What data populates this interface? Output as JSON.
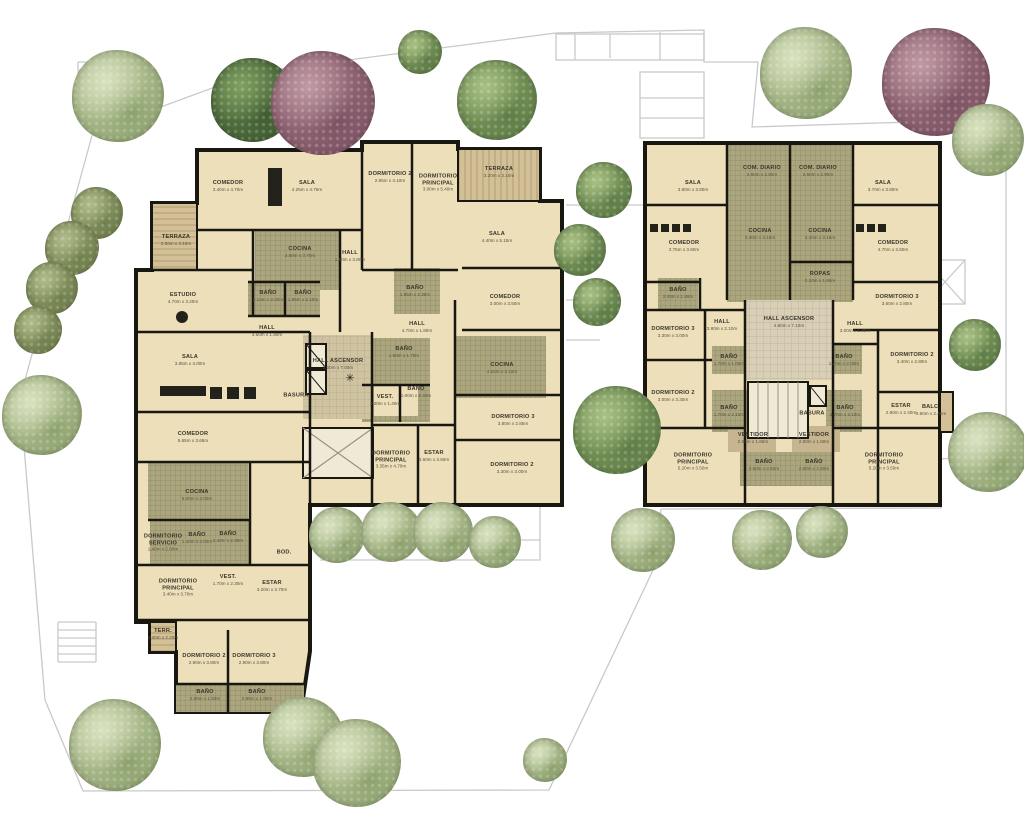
{
  "palette": {
    "floor": "#ecdfba",
    "floor_light": "#efe9d6",
    "tile": "#aba67e",
    "core_tile": "#cfc3a2",
    "wood": "#d3c096",
    "wood_stripe": "#b29c74",
    "wall": "#181810",
    "site_line": "#c9c9c9",
    "furniture": "#23221a",
    "trees": {
      "pale": {
        "hi": "#d9e2c0",
        "md": "#c3cfa6",
        "lo": "#8ba06b"
      },
      "green": {
        "hi": "#a9c084",
        "md": "#86a365",
        "lo": "#5d7c45"
      },
      "dark": {
        "hi": "#7fa062",
        "md": "#5f7f48",
        "lo": "#3f5c31"
      },
      "olive": {
        "hi": "#b0bc89",
        "md": "#93a06b",
        "lo": "#6f7f4c"
      },
      "red": {
        "hi": "#c09aa4",
        "md": "#9f7280",
        "lo": "#7c5262"
      }
    }
  },
  "icons": {
    "compass": "✳"
  },
  "rooms": [
    {
      "name": "COMEDOR",
      "dims": "3.40m x 4.70m",
      "x": 228,
      "y": 186
    },
    {
      "name": "SALA",
      "dims": "4.25m x 4.75m",
      "x": 307,
      "y": 186
    },
    {
      "name": "TERRAZA",
      "dims": "2.50m x 4.10m",
      "x": 176,
      "y": 240
    },
    {
      "name": "COCINA",
      "dims": "3.80m x 3.70m",
      "x": 300,
      "y": 252
    },
    {
      "name": "HALL",
      "dims": "1.50m x 3.80m",
      "x": 350,
      "y": 256
    },
    {
      "name": "ESTUDIO",
      "dims": "4.70m x 3.20m",
      "x": 183,
      "y": 298
    },
    {
      "name": "BAÑO",
      "dims": "2.10m x 2.00m",
      "x": 268,
      "y": 296
    },
    {
      "name": "BAÑO",
      "dims": "1.85m x 2.10m",
      "x": 303,
      "y": 296
    },
    {
      "name": "DORMITORIO 2",
      "dims": "2.85m x 4.10m",
      "x": 390,
      "y": 177
    },
    {
      "name": "DORMITORIO PRINCIPAL",
      "dims": "3.00m x 5.40m",
      "x": 438,
      "y": 183
    },
    {
      "name": "BAÑO",
      "dims": "1.85m x 2.35m",
      "x": 415,
      "y": 291
    },
    {
      "name": "HALL",
      "dims": "4.70m x 1.80m",
      "x": 417,
      "y": 327
    },
    {
      "name": "TERRAZA",
      "dims": "3.20m x 3.10m",
      "x": 499,
      "y": 172
    },
    {
      "name": "SALA",
      "dims": "4.40m x 5.15m",
      "x": 497,
      "y": 237
    },
    {
      "name": "COMEDOR",
      "dims": "3.00m x 3.50m",
      "x": 505,
      "y": 300
    },
    {
      "name": "COCINA",
      "dims": "4.55m x 3.10m",
      "x": 502,
      "y": 368
    },
    {
      "name": "BAÑO",
      "dims": "1.50m x 1.70m",
      "x": 404,
      "y": 352
    },
    {
      "name": "VEST.",
      "dims": "3.30m x 1.40m",
      "x": 385,
      "y": 400
    },
    {
      "name": "BAÑO",
      "dims": "1.00m x 2.40m",
      "x": 416,
      "y": 392
    },
    {
      "name": "DORMITORIO PRINCIPAL",
      "dims": "3.35m x 4.70m",
      "x": 391,
      "y": 460
    },
    {
      "name": "ESTAR",
      "dims": "3.60m x 3.60m",
      "x": 434,
      "y": 456
    },
    {
      "name": "DORMITORIO 3",
      "dims": "3.80m x 2.85m",
      "x": 513,
      "y": 420
    },
    {
      "name": "DORMITORIO 2",
      "dims": "3.30m x 3.00m",
      "x": 512,
      "y": 468
    },
    {
      "name": "HALL ASCENSOR",
      "dims": "3.00m x 7.00m",
      "x": 338,
      "y": 364
    },
    {
      "name": "BASURA",
      "dims": "",
      "x": 296,
      "y": 396
    },
    {
      "name": "SALA",
      "dims": "3.85m x 4.00m",
      "x": 190,
      "y": 360
    },
    {
      "name": "HALL",
      "dims": "3.50m x 1.90m",
      "x": 267,
      "y": 331
    },
    {
      "name": "COMEDOR",
      "dims": "5.65m x 3.65m",
      "x": 193,
      "y": 437
    },
    {
      "name": "COCINA",
      "dims": "5.00m x 3.00m",
      "x": 197,
      "y": 495
    },
    {
      "name": "DORMITORIO SERVICIO",
      "dims": "1.40m x 2.80m",
      "x": 163,
      "y": 543
    },
    {
      "name": "BAÑO",
      "dims": "1.40m x 2.00m",
      "x": 197,
      "y": 538
    },
    {
      "name": "BAÑO",
      "dims": "2.40m x 2.30m",
      "x": 228,
      "y": 537
    },
    {
      "name": "BOD.",
      "dims": "",
      "x": 284,
      "y": 553
    },
    {
      "name": "VEST.",
      "dims": "1.70m x 2.30m",
      "x": 228,
      "y": 580
    },
    {
      "name": "ESTAR",
      "dims": "3.20m x 3.70m",
      "x": 272,
      "y": 586
    },
    {
      "name": "DORMITORIO PRINCIPAL",
      "dims": "3.40m x 3.70m",
      "x": 178,
      "y": 588
    },
    {
      "name": "TERR.",
      "dims": "1.40m x 2.20m",
      "x": 163,
      "y": 634
    },
    {
      "name": "DORMITORIO 2",
      "dims": "2.90m x 3.80m",
      "x": 204,
      "y": 659
    },
    {
      "name": "DORMITORIO 3",
      "dims": "2.90m x 3.80m",
      "x": 254,
      "y": 659
    },
    {
      "name": "BAÑO",
      "dims": "2.85m x 1.50m",
      "x": 205,
      "y": 695
    },
    {
      "name": "BAÑO",
      "dims": "2.85m x 1.50m",
      "x": 257,
      "y": 695
    },
    {
      "name": "SALA",
      "dims": "3.80m x 3.80m",
      "x": 693,
      "y": 186
    },
    {
      "name": "COM. DIARIO",
      "dims": "2.50m x 2.90m",
      "x": 762,
      "y": 171
    },
    {
      "name": "COM. DIARIO",
      "dims": "2.50m x 2.90m",
      "x": 818,
      "y": 171
    },
    {
      "name": "SALA",
      "dims": "3.70m x 3.80m",
      "x": 883,
      "y": 186
    },
    {
      "name": "COCINA",
      "dims": "3.30m x 3.15m",
      "x": 760,
      "y": 234
    },
    {
      "name": "COCINA",
      "dims": "3.30m x 3.15m",
      "x": 820,
      "y": 234
    },
    {
      "name": "COMEDOR",
      "dims": "3.75m x 3.60m",
      "x": 684,
      "y": 246
    },
    {
      "name": "COMEDOR",
      "dims": "4.70m x 3.60m",
      "x": 893,
      "y": 246
    },
    {
      "name": "ROPAS",
      "dims": "2.20m x 1.60m",
      "x": 820,
      "y": 277
    },
    {
      "name": "BAÑO",
      "dims": "2.00m x 1.80m",
      "x": 678,
      "y": 293
    },
    {
      "name": "DORMITORIO 3",
      "dims": "3.30m x 3.00m",
      "x": 673,
      "y": 332
    },
    {
      "name": "HALL",
      "dims": "3.80m x 2.10m",
      "x": 722,
      "y": 325
    },
    {
      "name": "HALL ASCENSOR",
      "dims": "4.80m x 7.10m",
      "x": 789,
      "y": 322
    },
    {
      "name": "HALL",
      "dims": "3.00m x 1.80m",
      "x": 855,
      "y": 327
    },
    {
      "name": "DORMITORIO 3",
      "dims": "3.60m x 2.80m",
      "x": 897,
      "y": 300
    },
    {
      "name": "BAÑO",
      "dims": "1.70m x 1.05m",
      "x": 729,
      "y": 360
    },
    {
      "name": "BAÑO",
      "dims": "1.70m x 2.00m",
      "x": 844,
      "y": 360
    },
    {
      "name": "DORMITORIO 2",
      "dims": "3.00m x 3.30m",
      "x": 673,
      "y": 396
    },
    {
      "name": "DORMITORIO 2",
      "dims": "3.40m x 2.80m",
      "x": 912,
      "y": 358
    },
    {
      "name": "BAÑO",
      "dims": "1.70m x 2.10m",
      "x": 729,
      "y": 411
    },
    {
      "name": "BAÑO",
      "dims": "1.70m x 2.10m",
      "x": 845,
      "y": 411
    },
    {
      "name": "BASURA",
      "dims": "",
      "x": 812,
      "y": 414
    },
    {
      "name": "ESTAR",
      "dims": "2.90m x 2.40m",
      "x": 901,
      "y": 409
    },
    {
      "name": "BALC.",
      "dims": "0.80m x 2.40m",
      "x": 931,
      "y": 410
    },
    {
      "name": "VESTIDOR",
      "dims": "2.80m x 1.60m",
      "x": 753,
      "y": 438
    },
    {
      "name": "VESTIDOR",
      "dims": "2.80m x 1.60m",
      "x": 814,
      "y": 438
    },
    {
      "name": "BAÑO",
      "dims": "2.60m x 2.50m",
      "x": 764,
      "y": 465
    },
    {
      "name": "BAÑO",
      "dims": "2.60m x 2.50m",
      "x": 814,
      "y": 465
    },
    {
      "name": "DORMITORIO PRINCIPAL",
      "dims": "5.20m x 3.50m",
      "x": 693,
      "y": 462
    },
    {
      "name": "DORMITORIO PRINCIPAL",
      "dims": "5.20m x 3.50m",
      "x": 884,
      "y": 462
    }
  ],
  "trees": [
    {
      "type": "pale",
      "x": 118,
      "y": 96,
      "r": 46
    },
    {
      "type": "dark",
      "x": 253,
      "y": 100,
      "r": 42
    },
    {
      "type": "red",
      "x": 323,
      "y": 103,
      "r": 52
    },
    {
      "type": "green",
      "x": 497,
      "y": 100,
      "r": 40
    },
    {
      "type": "green",
      "x": 420,
      "y": 52,
      "r": 22
    },
    {
      "type": "pale",
      "x": 806,
      "y": 73,
      "r": 46
    },
    {
      "type": "red",
      "x": 936,
      "y": 82,
      "r": 54
    },
    {
      "type": "pale",
      "x": 988,
      "y": 140,
      "r": 36
    },
    {
      "type": "olive",
      "x": 97,
      "y": 213,
      "r": 26
    },
    {
      "type": "olive",
      "x": 72,
      "y": 248,
      "r": 27
    },
    {
      "type": "olive",
      "x": 52,
      "y": 288,
      "r": 26
    },
    {
      "type": "olive",
      "x": 38,
      "y": 330,
      "r": 24
    },
    {
      "type": "pale",
      "x": 42,
      "y": 415,
      "r": 40
    },
    {
      "type": "green",
      "x": 604,
      "y": 190,
      "r": 28
    },
    {
      "type": "green",
      "x": 580,
      "y": 250,
      "r": 26
    },
    {
      "type": "green",
      "x": 597,
      "y": 302,
      "r": 24
    },
    {
      "type": "green",
      "x": 617,
      "y": 430,
      "r": 44
    },
    {
      "type": "pale",
      "x": 643,
      "y": 540,
      "r": 32
    },
    {
      "type": "pale",
      "x": 337,
      "y": 535,
      "r": 28
    },
    {
      "type": "pale",
      "x": 391,
      "y": 532,
      "r": 30
    },
    {
      "type": "pale",
      "x": 443,
      "y": 532,
      "r": 30
    },
    {
      "type": "pale",
      "x": 495,
      "y": 542,
      "r": 26
    },
    {
      "type": "pale",
      "x": 762,
      "y": 540,
      "r": 30
    },
    {
      "type": "pale",
      "x": 822,
      "y": 532,
      "r": 26
    },
    {
      "type": "green",
      "x": 975,
      "y": 345,
      "r": 26
    },
    {
      "type": "pale",
      "x": 988,
      "y": 452,
      "r": 40
    },
    {
      "type": "pale",
      "x": 115,
      "y": 745,
      "r": 46
    },
    {
      "type": "pale",
      "x": 303,
      "y": 737,
      "r": 40
    },
    {
      "type": "pale",
      "x": 357,
      "y": 763,
      "r": 44
    },
    {
      "type": "pale",
      "x": 545,
      "y": 760,
      "r": 22
    }
  ]
}
